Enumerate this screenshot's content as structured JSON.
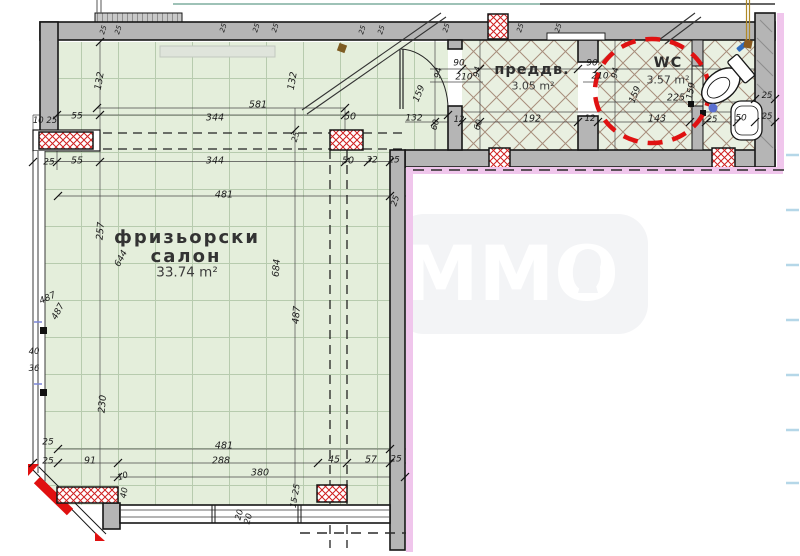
{
  "title": "floor-plan-drawing",
  "watermark": {
    "text": "MMO"
  },
  "rooms": {
    "salon": {
      "name": "фризьорски",
      "name2": "салон",
      "area": "33.74 m²"
    },
    "preddv": {
      "name": "преддв.",
      "area": "3.05 m²"
    },
    "wc": {
      "name": "WC",
      "area": "3.57 m²"
    }
  },
  "colors": {
    "floor_green": "#e4eedb",
    "grid_line": "#b7cbae",
    "hatch_brown": "#a78e7c",
    "wall_gray": "#b5b5b5",
    "red_accent": "#d81616",
    "pink_band": "#f0c6ec",
    "light_blue_dash": "#b5d7e8",
    "teal_line": "#7fae9f",
    "watermark_bg": "#f3f4f6"
  },
  "dims": [
    {
      "t": "25",
      "x": 104,
      "y": 30,
      "r": -72,
      "s": 7
    },
    {
      "t": "25",
      "x": 119,
      "y": 30,
      "r": -72,
      "s": 7
    },
    {
      "t": "25",
      "x": 224,
      "y": 28,
      "r": -72,
      "s": 7
    },
    {
      "t": "25",
      "x": 257,
      "y": 28,
      "r": -72,
      "s": 7
    },
    {
      "t": "25",
      "x": 276,
      "y": 28,
      "r": -72,
      "s": 7
    },
    {
      "t": "25",
      "x": 363,
      "y": 30,
      "r": -72,
      "s": 7
    },
    {
      "t": "25",
      "x": 382,
      "y": 30,
      "r": -72,
      "s": 7
    },
    {
      "t": "25",
      "x": 447,
      "y": 28,
      "r": -72,
      "s": 7
    },
    {
      "t": "25",
      "x": 521,
      "y": 28,
      "r": -72,
      "s": 7
    },
    {
      "t": "25",
      "x": 559,
      "y": 28,
      "r": -72,
      "s": 7
    },
    {
      "t": "10 25",
      "x": 45,
      "y": 121,
      "r": 0,
      "s": 8.5
    },
    {
      "t": "55",
      "x": 77,
      "y": 117,
      "r": 0,
      "s": 9
    },
    {
      "t": "344",
      "x": 215,
      "y": 118,
      "r": 0,
      "s": 9.5
    },
    {
      "t": "581",
      "x": 258,
      "y": 105,
      "r": 0,
      "s": 9.5
    },
    {
      "t": "50",
      "x": 350,
      "y": 117,
      "r": 0,
      "s": 9.5
    },
    {
      "t": "132",
      "x": 414,
      "y": 119,
      "r": 0,
      "s": 9
    },
    {
      "t": "60",
      "x": 436,
      "y": 125,
      "r": -75,
      "s": 8.5
    },
    {
      "t": "12",
      "x": 459,
      "y": 120,
      "r": 0,
      "s": 8.5
    },
    {
      "t": "60",
      "x": 479,
      "y": 125,
      "r": -75,
      "s": 8.5
    },
    {
      "t": "192",
      "x": 532,
      "y": 119,
      "r": 0,
      "s": 9.5
    },
    {
      "t": "12",
      "x": 590,
      "y": 119,
      "r": 0,
      "s": 8.5
    },
    {
      "t": "143",
      "x": 657,
      "y": 119,
      "r": 0,
      "s": 9.5
    },
    {
      "t": "25",
      "x": 712,
      "y": 120,
      "r": 0,
      "s": 8.5
    },
    {
      "t": "50",
      "x": 741,
      "y": 119,
      "r": 0,
      "s": 9
    },
    {
      "t": "25",
      "x": 767,
      "y": 96,
      "r": 0,
      "s": 8.5
    },
    {
      "t": "25",
      "x": 767,
      "y": 117,
      "r": 0,
      "s": 8.5
    },
    {
      "t": "25",
      "x": 49,
      "y": 163,
      "r": 0,
      "s": 9
    },
    {
      "t": "55",
      "x": 77,
      "y": 161,
      "r": 0,
      "s": 9.5
    },
    {
      "t": "344",
      "x": 215,
      "y": 161,
      "r": 0,
      "s": 9.5
    },
    {
      "t": "50",
      "x": 348,
      "y": 161,
      "r": 0,
      "s": 9.5
    },
    {
      "t": "32",
      "x": 372,
      "y": 161,
      "r": 0,
      "s": 9
    },
    {
      "t": "25",
      "x": 394,
      "y": 161,
      "r": 0,
      "s": 9
    },
    {
      "t": "132",
      "x": 100,
      "y": 81,
      "r": -80,
      "s": 9.5
    },
    {
      "t": "132",
      "x": 293,
      "y": 81,
      "r": -80,
      "s": 9.5
    },
    {
      "t": "25",
      "x": 296,
      "y": 137,
      "r": -72,
      "s": 8
    },
    {
      "t": "25",
      "x": 396,
      "y": 201,
      "r": -72,
      "s": 8.5
    },
    {
      "t": "257",
      "x": 101,
      "y": 231,
      "r": -85,
      "s": 9.5
    },
    {
      "t": "644",
      "x": 122,
      "y": 259,
      "r": -62,
      "s": 9
    },
    {
      "t": "684",
      "x": 277,
      "y": 268,
      "r": -85,
      "s": 9.5
    },
    {
      "t": "487",
      "x": 48,
      "y": 299,
      "r": -25,
      "s": 9
    },
    {
      "t": "487",
      "x": 59,
      "y": 312,
      "r": -62,
      "s": 9
    },
    {
      "t": "40",
      "x": 34,
      "y": 352,
      "r": 0,
      "s": 8.5
    },
    {
      "t": "36",
      "x": 34,
      "y": 369,
      "r": 0,
      "s": 8.5
    },
    {
      "t": "230",
      "x": 103,
      "y": 404,
      "r": -85,
      "s": 9.5
    },
    {
      "t": "487",
      "x": 297,
      "y": 315,
      "r": -85,
      "s": 9.5
    },
    {
      "t": "94",
      "x": 439,
      "y": 73,
      "r": -80,
      "s": 8.5
    },
    {
      "t": "90",
      "x": 459,
      "y": 64,
      "r": 0,
      "s": 9
    },
    {
      "t": "210",
      "x": 464,
      "y": 78,
      "r": 0,
      "s": 9
    },
    {
      "t": "94",
      "x": 478,
      "y": 72,
      "r": -80,
      "s": 8.5
    },
    {
      "t": "159",
      "x": 420,
      "y": 94,
      "r": -68,
      "s": 9
    },
    {
      "t": "90",
      "x": 592,
      "y": 64,
      "r": 0,
      "s": 9
    },
    {
      "t": "210",
      "x": 600,
      "y": 77,
      "r": 0,
      "s": 9
    },
    {
      "t": "94",
      "x": 616,
      "y": 73,
      "r": -80,
      "s": 8.5
    },
    {
      "t": "159",
      "x": 636,
      "y": 95,
      "r": -68,
      "s": 9
    },
    {
      "t": "225",
      "x": 676,
      "y": 98,
      "r": 0,
      "s": 9.5
    },
    {
      "t": "159",
      "x": 692,
      "y": 91,
      "r": -80,
      "s": 9
    },
    {
      "t": "481",
      "x": 224,
      "y": 195,
      "r": 0,
      "s": 9.5
    },
    {
      "t": "481",
      "x": 224,
      "y": 446,
      "r": 0,
      "s": 9.5
    },
    {
      "t": "91",
      "x": 90,
      "y": 461,
      "r": 0,
      "s": 9.5
    },
    {
      "t": "288",
      "x": 221,
      "y": 461,
      "r": 0,
      "s": 9.5
    },
    {
      "t": "380",
      "x": 260,
      "y": 473,
      "r": 0,
      "s": 9.5
    },
    {
      "t": "45",
      "x": 334,
      "y": 460,
      "r": 0,
      "s": 9.5
    },
    {
      "t": "57",
      "x": 371,
      "y": 460,
      "r": 0,
      "s": 9.5
    },
    {
      "t": "25",
      "x": 396,
      "y": 460,
      "r": 0,
      "s": 9
    },
    {
      "t": "25",
      "x": 48,
      "y": 443,
      "r": 0,
      "s": 9
    },
    {
      "t": "25",
      "x": 48,
      "y": 462,
      "r": 0,
      "s": 9
    },
    {
      "t": "10",
      "x": 123,
      "y": 477,
      "r": -20,
      "s": 8.5
    },
    {
      "t": "40",
      "x": 125,
      "y": 493,
      "r": -80,
      "s": 8.5
    },
    {
      "t": "15 25",
      "x": 296,
      "y": 496,
      "r": -80,
      "s": 8.5
    },
    {
      "t": "20",
      "x": 240,
      "y": 515,
      "r": -75,
      "s": 8.5
    },
    {
      "t": "20",
      "x": 249,
      "y": 519,
      "r": -75,
      "s": 8.5
    }
  ]
}
